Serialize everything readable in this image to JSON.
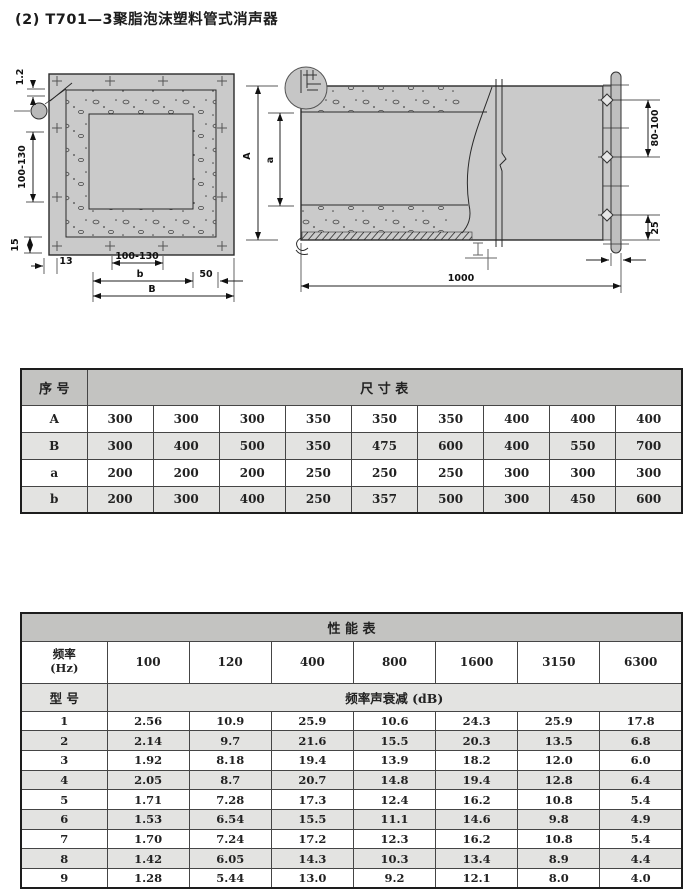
{
  "page": {
    "title": "(2) T701—3聚脂泡沫塑料管式消声器"
  },
  "drawing": {
    "labels": {
      "thickness": "1.2",
      "left_range": "100-130",
      "d15": "15",
      "d13": "13",
      "bottom_range": "100-130",
      "b": "b",
      "d50": "50",
      "B": "B",
      "A": "A",
      "a": "a",
      "bolt_range": "80-100",
      "d25": "25",
      "length": "1000"
    }
  },
  "size_table": {
    "corner": "序  号",
    "title": "尺  寸  表",
    "rows": [
      {
        "label": "A",
        "values": [
          "300",
          "300",
          "300",
          "350",
          "350",
          "350",
          "400",
          "400",
          "400"
        ]
      },
      {
        "label": "B",
        "values": [
          "300",
          "400",
          "500",
          "350",
          "475",
          "600",
          "400",
          "550",
          "700"
        ]
      },
      {
        "label": "a",
        "values": [
          "200",
          "200",
          "200",
          "250",
          "250",
          "250",
          "300",
          "300",
          "300"
        ]
      },
      {
        "label": "b",
        "values": [
          "200",
          "300",
          "400",
          "250",
          "357",
          "500",
          "300",
          "450",
          "600"
        ]
      }
    ]
  },
  "perf_table": {
    "title": "性  能  表",
    "freq_label_line1": "频率",
    "freq_label_line2": "(Hz)",
    "frequencies": [
      "100",
      "120",
      "400",
      "800",
      "1600",
      "3150",
      "6300"
    ],
    "model_label": "型 号",
    "attenuation_label": "频率声衰减 (dB)",
    "rows": [
      {
        "model": "1",
        "values": [
          "2.56",
          "10.9",
          "25.9",
          "10.6",
          "24.3",
          "25.9",
          "17.8"
        ]
      },
      {
        "model": "2",
        "values": [
          "2.14",
          "9.7",
          "21.6",
          "15.5",
          "20.3",
          "13.5",
          "6.8"
        ]
      },
      {
        "model": "3",
        "values": [
          "1.92",
          "8.18",
          "19.4",
          "13.9",
          "18.2",
          "12.0",
          "6.0"
        ]
      },
      {
        "model": "4",
        "values": [
          "2.05",
          "8.7",
          "20.7",
          "14.8",
          "19.4",
          "12.8",
          "6.4"
        ]
      },
      {
        "model": "5",
        "values": [
          "1.71",
          "7.28",
          "17.3",
          "12.4",
          "16.2",
          "10.8",
          "5.4"
        ]
      },
      {
        "model": "6",
        "values": [
          "1.53",
          "6.54",
          "15.5",
          "11.1",
          "14.6",
          "9.8",
          "4.9"
        ]
      },
      {
        "model": "7",
        "values": [
          "1.70",
          "7.24",
          "17.2",
          "12.3",
          "16.2",
          "10.8",
          "5.4"
        ]
      },
      {
        "model": "8",
        "values": [
          "1.42",
          "6.05",
          "14.3",
          "10.3",
          "13.4",
          "8.9",
          "4.4"
        ]
      },
      {
        "model": "9",
        "values": [
          "1.28",
          "5.44",
          "13.0",
          "9.2",
          "12.1",
          "8.0",
          "4.0"
        ]
      }
    ]
  }
}
